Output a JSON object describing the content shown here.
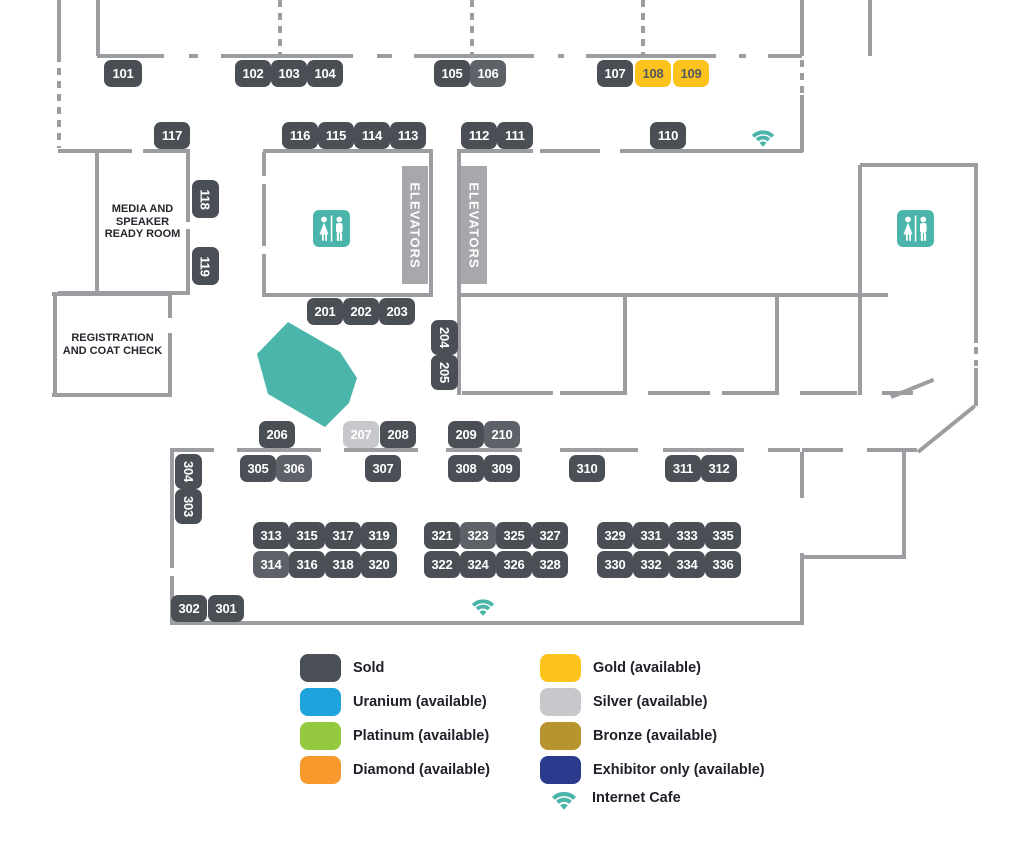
{
  "colors": {
    "wall": "#9b9da1",
    "sold": "#4a4f56",
    "soldLight": "#5d6168",
    "gold": "#fdc31d",
    "goldText": "#54585e",
    "silver": "#c6c8cb",
    "teal": "#4cb5ab",
    "elevatorBar": "#a6a8ab",
    "boothText": "#ffffff",
    "roomText": "#26262e",
    "legendText": "#20202a"
  },
  "map": {
    "booths": [
      {
        "n": "101",
        "x": 104,
        "y": 60,
        "w": 38,
        "h": 27
      },
      {
        "n": "102",
        "x": 235,
        "y": 60,
        "w": 36,
        "h": 27
      },
      {
        "n": "103",
        "x": 271,
        "y": 60,
        "w": 36,
        "h": 27
      },
      {
        "n": "104",
        "x": 307,
        "y": 60,
        "w": 36,
        "h": 27
      },
      {
        "n": "105",
        "x": 434,
        "y": 60,
        "w": 36,
        "h": 27
      },
      {
        "n": "106",
        "x": 470,
        "y": 60,
        "w": 36,
        "h": 27,
        "variant": "soldLight"
      },
      {
        "n": "107",
        "x": 597,
        "y": 60,
        "w": 36,
        "h": 27
      },
      {
        "n": "108",
        "x": 635,
        "y": 60,
        "w": 36,
        "h": 27,
        "variant": "gold"
      },
      {
        "n": "109",
        "x": 673,
        "y": 60,
        "w": 36,
        "h": 27,
        "variant": "gold"
      },
      {
        "n": "117",
        "x": 154,
        "y": 122,
        "w": 36,
        "h": 27
      },
      {
        "n": "116",
        "x": 282,
        "y": 122,
        "w": 36,
        "h": 27
      },
      {
        "n": "115",
        "x": 318,
        "y": 122,
        "w": 36,
        "h": 27
      },
      {
        "n": "114",
        "x": 354,
        "y": 122,
        "w": 36,
        "h": 27
      },
      {
        "n": "113",
        "x": 390,
        "y": 122,
        "w": 36,
        "h": 27
      },
      {
        "n": "112",
        "x": 461,
        "y": 122,
        "w": 36,
        "h": 27
      },
      {
        "n": "111",
        "x": 497,
        "y": 122,
        "w": 36,
        "h": 27
      },
      {
        "n": "110",
        "x": 650,
        "y": 122,
        "w": 36,
        "h": 27
      },
      {
        "n": "118",
        "x": 192,
        "y": 180,
        "w": 27,
        "h": 38,
        "rotated": true
      },
      {
        "n": "119",
        "x": 192,
        "y": 247,
        "w": 27,
        "h": 38,
        "rotated": true
      },
      {
        "n": "201",
        "x": 307,
        "y": 298,
        "w": 36,
        "h": 27
      },
      {
        "n": "202",
        "x": 343,
        "y": 298,
        "w": 36,
        "h": 27
      },
      {
        "n": "203",
        "x": 379,
        "y": 298,
        "w": 36,
        "h": 27
      },
      {
        "n": "204",
        "x": 431,
        "y": 320,
        "w": 27,
        "h": 35,
        "rotated": true
      },
      {
        "n": "205",
        "x": 431,
        "y": 355,
        "w": 27,
        "h": 35,
        "rotated": true
      },
      {
        "n": "206",
        "x": 259,
        "y": 421,
        "w": 36,
        "h": 27
      },
      {
        "n": "207",
        "x": 343,
        "y": 421,
        "w": 36,
        "h": 27,
        "variant": "silver"
      },
      {
        "n": "208",
        "x": 380,
        "y": 421,
        "w": 36,
        "h": 27
      },
      {
        "n": "209",
        "x": 448,
        "y": 421,
        "w": 36,
        "h": 27
      },
      {
        "n": "210",
        "x": 484,
        "y": 421,
        "w": 36,
        "h": 27,
        "variant": "soldLight"
      },
      {
        "n": "304",
        "x": 175,
        "y": 454,
        "w": 27,
        "h": 35,
        "rotated": true
      },
      {
        "n": "303",
        "x": 175,
        "y": 489,
        "w": 27,
        "h": 35,
        "rotated": true
      },
      {
        "n": "305",
        "x": 240,
        "y": 455,
        "w": 36,
        "h": 27
      },
      {
        "n": "306",
        "x": 276,
        "y": 455,
        "w": 36,
        "h": 27,
        "variant": "soldLight"
      },
      {
        "n": "307",
        "x": 365,
        "y": 455,
        "w": 36,
        "h": 27
      },
      {
        "n": "308",
        "x": 448,
        "y": 455,
        "w": 36,
        "h": 27
      },
      {
        "n": "309",
        "x": 484,
        "y": 455,
        "w": 36,
        "h": 27
      },
      {
        "n": "310",
        "x": 569,
        "y": 455,
        "w": 36,
        "h": 27
      },
      {
        "n": "311",
        "x": 665,
        "y": 455,
        "w": 36,
        "h": 27
      },
      {
        "n": "312",
        "x": 701,
        "y": 455,
        "w": 36,
        "h": 27
      },
      {
        "n": "313",
        "x": 253,
        "y": 522,
        "w": 36,
        "h": 27
      },
      {
        "n": "315",
        "x": 289,
        "y": 522,
        "w": 36,
        "h": 27
      },
      {
        "n": "317",
        "x": 325,
        "y": 522,
        "w": 36,
        "h": 27
      },
      {
        "n": "319",
        "x": 361,
        "y": 522,
        "w": 36,
        "h": 27
      },
      {
        "n": "314",
        "x": 253,
        "y": 551,
        "w": 36,
        "h": 27,
        "variant": "soldLight"
      },
      {
        "n": "316",
        "x": 289,
        "y": 551,
        "w": 36,
        "h": 27
      },
      {
        "n": "318",
        "x": 325,
        "y": 551,
        "w": 36,
        "h": 27
      },
      {
        "n": "320",
        "x": 361,
        "y": 551,
        "w": 36,
        "h": 27
      },
      {
        "n": "321",
        "x": 424,
        "y": 522,
        "w": 36,
        "h": 27
      },
      {
        "n": "323",
        "x": 460,
        "y": 522,
        "w": 36,
        "h": 27,
        "variant": "soldLight"
      },
      {
        "n": "325",
        "x": 496,
        "y": 522,
        "w": 36,
        "h": 27
      },
      {
        "n": "327",
        "x": 532,
        "y": 522,
        "w": 36,
        "h": 27
      },
      {
        "n": "322",
        "x": 424,
        "y": 551,
        "w": 36,
        "h": 27
      },
      {
        "n": "324",
        "x": 460,
        "y": 551,
        "w": 36,
        "h": 27
      },
      {
        "n": "326",
        "x": 496,
        "y": 551,
        "w": 36,
        "h": 27
      },
      {
        "n": "328",
        "x": 532,
        "y": 551,
        "w": 36,
        "h": 27
      },
      {
        "n": "329",
        "x": 597,
        "y": 522,
        "w": 36,
        "h": 27
      },
      {
        "n": "331",
        "x": 633,
        "y": 522,
        "w": 36,
        "h": 27
      },
      {
        "n": "333",
        "x": 669,
        "y": 522,
        "w": 36,
        "h": 27
      },
      {
        "n": "335",
        "x": 705,
        "y": 522,
        "w": 36,
        "h": 27
      },
      {
        "n": "330",
        "x": 597,
        "y": 551,
        "w": 36,
        "h": 27
      },
      {
        "n": "332",
        "x": 633,
        "y": 551,
        "w": 36,
        "h": 27
      },
      {
        "n": "334",
        "x": 669,
        "y": 551,
        "w": 36,
        "h": 27
      },
      {
        "n": "336",
        "x": 705,
        "y": 551,
        "w": 36,
        "h": 27
      },
      {
        "n": "302",
        "x": 171,
        "y": 595,
        "w": 36,
        "h": 27
      },
      {
        "n": "301",
        "x": 208,
        "y": 595,
        "w": 36,
        "h": 27
      }
    ],
    "rooms": [
      {
        "id": "media-speaker-ready-room",
        "x": 97,
        "y": 152,
        "w": 91,
        "h": 140,
        "lines": [
          "MEDIA AND",
          "SPEAKER",
          "READY ROOM"
        ]
      },
      {
        "id": "registration-coat-check",
        "x": 55,
        "y": 296,
        "w": 115,
        "h": 98,
        "lines": [
          "REGISTRATION",
          "AND COAT CHECK"
        ]
      }
    ],
    "elevator_label": "ELEVATORS",
    "elevators": [
      {
        "x": 402,
        "y": 166,
        "w": 26,
        "h": 118
      },
      {
        "x": 461,
        "y": 166,
        "w": 26,
        "h": 118
      }
    ],
    "restrooms": [
      {
        "x": 313,
        "y": 210,
        "s": 37
      },
      {
        "x": 897,
        "y": 210,
        "s": 37
      }
    ],
    "wifi_spots": [
      {
        "x": 748,
        "y": 124,
        "w": 30,
        "h": 24
      },
      {
        "x": 468,
        "y": 593,
        "w": 30,
        "h": 24
      }
    ],
    "stage_area": {
      "x": 255,
      "y": 318,
      "w": 104,
      "h": 112,
      "points": [
        [
          33,
          4
        ],
        [
          85,
          34
        ],
        [
          102,
          60
        ],
        [
          94,
          85
        ],
        [
          70,
          109
        ],
        [
          13,
          76
        ],
        [
          2,
          36
        ]
      ]
    },
    "walls": {
      "h": [
        [
          97,
          54,
          67
        ],
        [
          189,
          54,
          9
        ],
        [
          221,
          54,
          132
        ],
        [
          377,
          54,
          15
        ],
        [
          414,
          54,
          120
        ],
        [
          558,
          54,
          6
        ],
        [
          586,
          54,
          130
        ],
        [
          739,
          54,
          7
        ],
        [
          768,
          54,
          34
        ],
        [
          58,
          149,
          74
        ],
        [
          143,
          149,
          47
        ],
        [
          263,
          149,
          170
        ],
        [
          457,
          149,
          76
        ],
        [
          540,
          149,
          60
        ],
        [
          620,
          149,
          183
        ],
        [
          860,
          163,
          118
        ],
        [
          58,
          291,
          132
        ],
        [
          262,
          293,
          170
        ],
        [
          457,
          293,
          431
        ],
        [
          52,
          292,
          120
        ],
        [
          52,
          393,
          120
        ],
        [
          462,
          391,
          91
        ],
        [
          560,
          391,
          65
        ],
        [
          648,
          391,
          62
        ],
        [
          722,
          391,
          55
        ],
        [
          800,
          391,
          57
        ],
        [
          882,
          391,
          31
        ],
        [
          170,
          448,
          44
        ],
        [
          237,
          448,
          84
        ],
        [
          344,
          448,
          74
        ],
        [
          446,
          448,
          76
        ],
        [
          560,
          448,
          78
        ],
        [
          663,
          448,
          81
        ],
        [
          768,
          448,
          32
        ],
        [
          802,
          448,
          41
        ],
        [
          867,
          448,
          50
        ],
        [
          802,
          555,
          102
        ],
        [
          170,
          621,
          634
        ]
      ],
      "v": [
        [
          57,
          0,
          62
        ],
        [
          96,
          0,
          56
        ],
        [
          800,
          0,
          56
        ],
        [
          868,
          0,
          56
        ],
        [
          800,
          95,
          57
        ],
        [
          95,
          151,
          144
        ],
        [
          186,
          151,
          71
        ],
        [
          186,
          229,
          66
        ],
        [
          53,
          294,
          103
        ],
        [
          168,
          294,
          24
        ],
        [
          168,
          333,
          64
        ],
        [
          262,
          152,
          24
        ],
        [
          262,
          184,
          62
        ],
        [
          262,
          254,
          43
        ],
        [
          429,
          152,
          145
        ],
        [
          457,
          152,
          243
        ],
        [
          623,
          297,
          98
        ],
        [
          775,
          297,
          98
        ],
        [
          858,
          165,
          230
        ],
        [
          974,
          165,
          178
        ],
        [
          974,
          368,
          38
        ],
        [
          170,
          448,
          120
        ],
        [
          170,
          576,
          49
        ],
        [
          800,
          452,
          46
        ],
        [
          800,
          553,
          72
        ],
        [
          902,
          452,
          107
        ]
      ],
      "v_dashed": [
        [
          57,
          68,
          80
        ],
        [
          278,
          0,
          56
        ],
        [
          470,
          0,
          56
        ],
        [
          641,
          0,
          56
        ],
        [
          800,
          60,
          33
        ],
        [
          974,
          347,
          19
        ]
      ],
      "diag": [
        {
          "x": 891,
          "y": 395,
          "len": 46,
          "angle": -22
        },
        {
          "x": 918,
          "y": 450,
          "len": 73,
          "angle": -39
        }
      ]
    }
  },
  "legend": {
    "columns": [
      {
        "x": 300,
        "items": [
          {
            "label": "Sold",
            "color": "#4a4f56",
            "y": 654
          },
          {
            "label": "Uranium (available)",
            "color": "#1ea3dc",
            "y": 688
          },
          {
            "label": "Platinum (available)",
            "color": "#94c83e",
            "y": 722
          },
          {
            "label": "Diamond (available)",
            "color": "#f8982d",
            "y": 756
          }
        ]
      },
      {
        "x": 540,
        "items": [
          {
            "label": "Gold (available)",
            "color": "#fdc31d",
            "y": 654
          },
          {
            "label": "Silver (available)",
            "color": "#c6c8cb",
            "y": 688
          },
          {
            "label": "Bronze (available)",
            "color": "#b6952e",
            "y": 722
          },
          {
            "label": "Exhibitor only (available)",
            "color": "#2b3a8c",
            "y": 756
          }
        ]
      }
    ],
    "internet": {
      "label": "Internet Cafe",
      "x": 544,
      "y": 785
    }
  }
}
